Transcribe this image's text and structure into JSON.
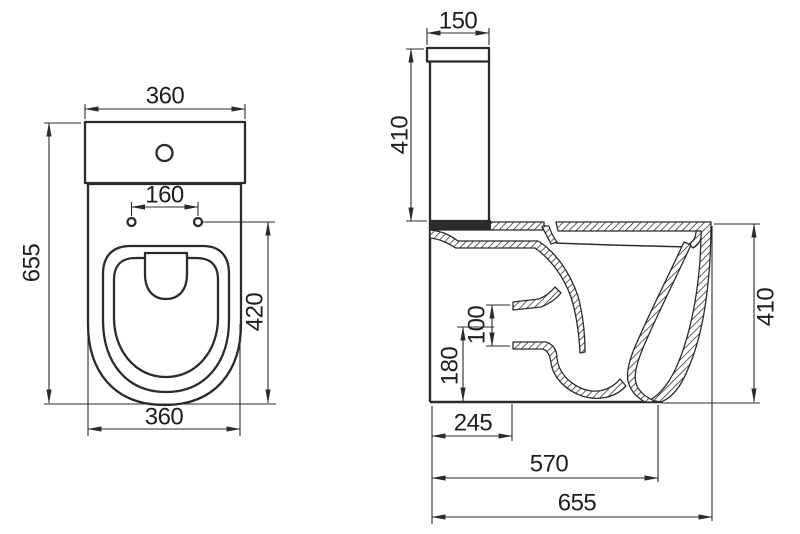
{
  "drawing": {
    "description": "Toilet (close-coupled WC) dimensional technical drawing, two orthographic views",
    "units": "mm",
    "colors": {
      "background": "#ffffff",
      "line": "#2b2b2b",
      "text": "#1e1e1e"
    }
  },
  "top_view": {
    "label": "top view",
    "dims": {
      "tank_width": "360",
      "bolt_hole_spacing": "160",
      "overall_depth": "655",
      "seat_length": "420",
      "base_width": "360"
    }
  },
  "side_view": {
    "label": "side section view",
    "dims": {
      "lid_depth": "150",
      "tank_height": "410",
      "outlet_diameter": "100",
      "outlet_center_height": "180",
      "outlet_setout": "245",
      "bowl_projection": "570",
      "overall_length": "655",
      "rim_height": "410"
    }
  }
}
